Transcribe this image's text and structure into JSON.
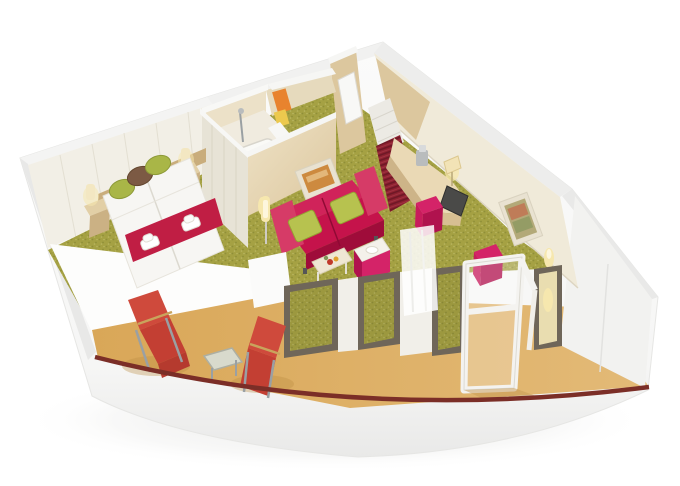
{
  "scene": {
    "type": "3d-cutaway-floorplan",
    "subject": "cruise-ship-balcony-suite",
    "rooms": [
      {
        "name": "bedroom",
        "items": [
          "double-bed",
          "bed-runner",
          "folded-towels",
          "green-pillow",
          "brown-pillow",
          "nightstand",
          "wall-sconce",
          "headboard-panel-wall"
        ]
      },
      {
        "name": "bathroom",
        "items": [
          "bathtub",
          "shower-fixture",
          "orange-towel",
          "yellow-towel",
          "partition-wall",
          "frosted-glass-wall"
        ]
      },
      {
        "name": "living-area",
        "items": [
          "two-seat-sofa",
          "green-cushion",
          "wall-picture",
          "wall-sconce",
          "floor-lamp",
          "coffee-table",
          "side-table",
          "curved-desk",
          "desk-lamp",
          "tv",
          "espresso-machine",
          "pink-stool",
          "pink-ottoman",
          "wall-art",
          "wall-lamp"
        ]
      },
      {
        "name": "entrance-hall",
        "items": [
          "entrance-door",
          "stairs",
          "striped-red-carpet",
          "wardrobe"
        ]
      },
      {
        "name": "balcony",
        "items": [
          "lounge-chair",
          "lounge-chair",
          "glass-table",
          "open-balcony-door",
          "floor-to-ceiling-window",
          "sheer-curtain",
          "hull-stripe"
        ]
      }
    ]
  },
  "colors": {
    "background": "#ffffff",
    "hull_white": "#f7f7f6",
    "hull_shadow": "#e7e7e6",
    "accent_stripe": "#7b2e27",
    "balcony_floor": "#dcab5f",
    "carpet": "#a5a143",
    "carpet_dot_dark": "#8f8e38",
    "carpet_dot_light": "#b9b661",
    "corridor_carpet": "#8f2130",
    "corridor_stripe": "#6e1826",
    "wall_white": "#f3f2ef",
    "wall_cream": "#f2efe6",
    "interior_cream": "#f0ead9",
    "wood_light": "#e9dcbd",
    "wood_mid": "#dcc79e",
    "wood_dark": "#c9ad7c",
    "desk_wood": "#ead9b5",
    "tile": "#ece1c8",
    "frosted_glass": "#e7e3d6",
    "bed_white": "#f7f6f3",
    "runner_red": "#c01e44",
    "pillow_green": "#a9b647",
    "pillow_brown": "#7c5a44",
    "sofa_main": "#c5134b",
    "sofa_dark": "#9f0c3a",
    "sofa_light": "#d63b67",
    "cushion_green": "#b7c24f",
    "stool_pink": "#d42368",
    "stool_pink_dark": "#b0124e",
    "deckchair_red": "#cf4a3c",
    "frame_gray": "#9aa0a3",
    "window_frame": "#6f6659",
    "curtain_white": "#fbfbfa",
    "glow_warm": "#f6e7ae",
    "art_orange": "#cd8a3f",
    "frame_cream": "#e9e2d1",
    "towel_orange": "#e8832e",
    "towel_yellow": "#ecc94e",
    "tv_dark": "#4a4a48",
    "metal": "#b9bcbd"
  }
}
